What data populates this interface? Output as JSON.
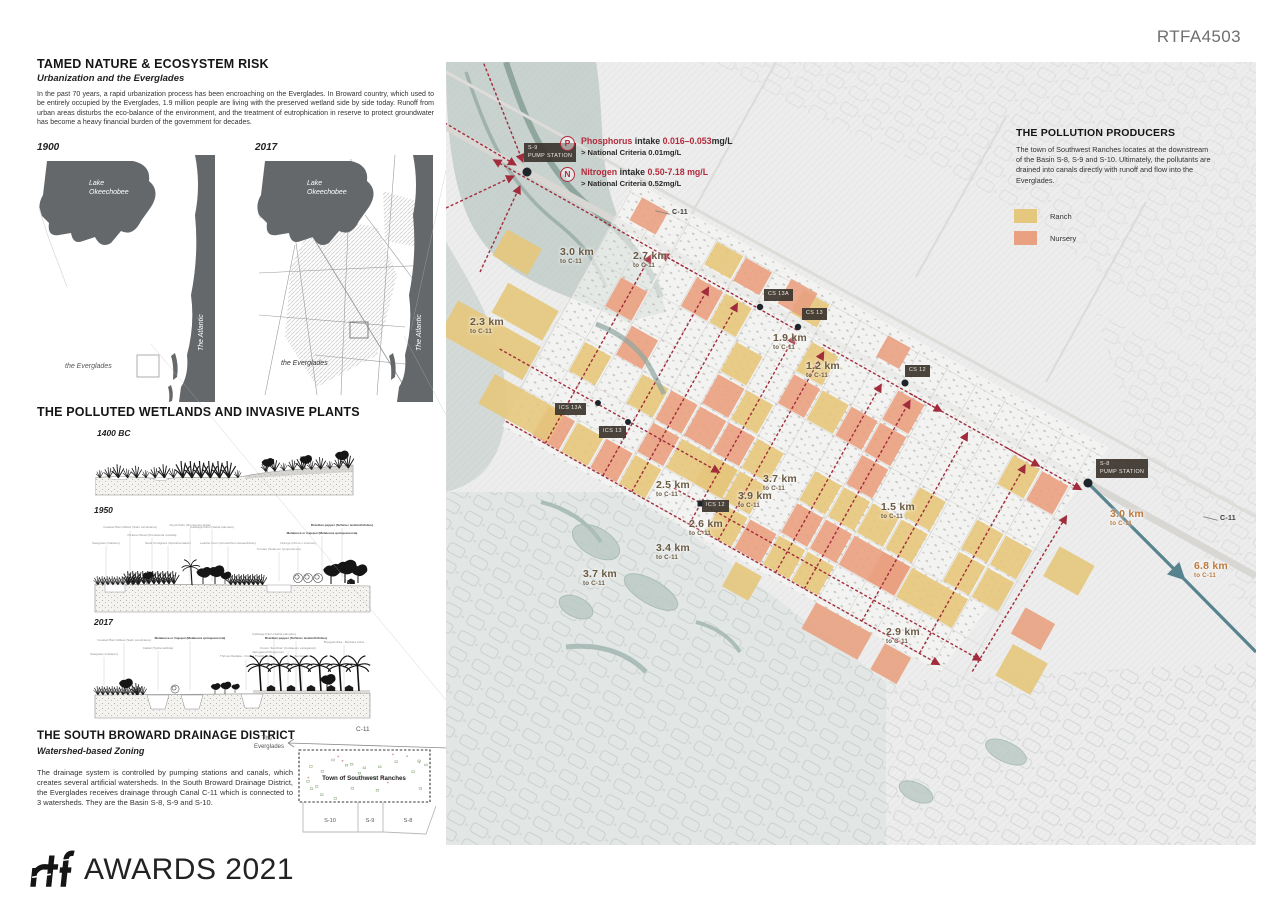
{
  "header": {
    "code": "RTFA4503"
  },
  "left": {
    "s1_title": "TAMED NATURE & ECOSYSTEM RISK",
    "s1_subtitle": "Urbanization and the Everglades",
    "s1_body": "In the past 70 years, a rapid urbanization process has been encroaching on the Everglades. In Broward country, which used to be entirely occupied by the Everglades, 1.9 million people are living with the preserved wetland side by side today. Runoff from urban areas disturbs the eco-balance of the environment, and the treatment of eutrophication in reserve to protect groundwater has become a heavy financial burden of the government for decades.",
    "maps": {
      "y1": "1900",
      "y2": "2017",
      "lake_l1": "Lake",
      "lake_l2": "Okeechobee",
      "everglades": "the Everglades",
      "atlantic": "The Atlantic"
    },
    "s2_title": "THE POLLUTED WETLANDS AND INVASIVE PLANTS",
    "eras": [
      "1400 BC",
      "1950",
      "2017"
    ],
    "plants1950": [
      {
        "t": "Sawgrass (Cladium)",
        "x": 10,
        "y": 30
      },
      {
        "t": "Coastal Plain Willow (Salix caroliniana)",
        "x": 34,
        "y": 14
      },
      {
        "t": "Pickerel Weed (Pontederia cordata)",
        "x": 56,
        "y": 22
      },
      {
        "t": "Sand Cordgrass (Spartina bakeri)",
        "x": 72,
        "y": 30
      },
      {
        "t": "Royal Palm (Roystonea elata)",
        "x": 94,
        "y": 12
      },
      {
        "t": "Cabbage Palm (Sabal palmetto)",
        "x": 116,
        "y": 14
      },
      {
        "t": "Leather Fern (Acrostichum danaeifolium)",
        "x": 132,
        "y": 30
      },
      {
        "t": "Tomato (Solanum lycopersicum)",
        "x": 183,
        "y": 36
      },
      {
        "t": "Orange (Citrus x sinensis)",
        "x": 202,
        "y": 30
      },
      {
        "t": "Melaleuca or Cajeput (Melaleuca quinquenervia)",
        "x": 226,
        "y": 20,
        "b": 1
      },
      {
        "t": "Brazilian pepper (Schinus terebinthifolius)",
        "x": 246,
        "y": 12,
        "b": 1
      }
    ],
    "plants2017": [
      {
        "t": "Sawgrass (Cladium)",
        "x": 8,
        "y": 28
      },
      {
        "t": "Coastal Plain Willow (Salix caroliniana)",
        "x": 28,
        "y": 14
      },
      {
        "t": "Cattail (Typha latifolia)",
        "x": 62,
        "y": 22
      },
      {
        "t": "Melaleuca or Cajeput (Melaleuca quinquenervia)",
        "x": 94,
        "y": 12,
        "b": 1
      },
      {
        "t": "Thrinax Radiata - Florida Thatch Palm",
        "x": 150,
        "y": 30
      },
      {
        "t": "Variegated Pittosporum",
        "x": 172,
        "y": 26
      },
      {
        "t": "Croton 'Zanzibar' (Codiaeum variegatum)",
        "x": 192,
        "y": 22
      },
      {
        "t": "Succulents",
        "x": 206,
        "y": 30
      },
      {
        "t": "Cabbage Palm (Sabal palmetto)",
        "x": 178,
        "y": 8
      },
      {
        "t": "Brazilian pepper (Schinus terebinthifolius)",
        "x": 200,
        "y": 12,
        "b": 1
      },
      {
        "t": "Bougainvillea - Barbara Karst",
        "x": 248,
        "y": 16
      }
    ],
    "s3_title": "THE SOUTH BROWARD DRAINAGE DISTRICT",
    "s3_subtitle": "Watershed-based Zoning",
    "s3_body": "The drainage system is controlled by pumping stations and canals, which creates several artificial watersheds. In the South Broward Drainage District, the Everglades receives drainage through Canal C-11 which is connected to 3 watersheds. They are the Basin S-8, S-9 and S-10.",
    "inset": {
      "canal": "C-11",
      "the": "The",
      "everglades": "Everglades",
      "town": "Town of Southwest Ranches",
      "basins": [
        "S-10",
        "S-9",
        "S-8"
      ]
    }
  },
  "map": {
    "producers_title": "THE POLLUTION PRODUCERS",
    "producers_body": "The town of Southwest Ranches locates at the downstream of the Basin S-8, S-9 and S-10. Ultimately, the pollutants  are drained into canals directly with runoff and flow into the Everglades.",
    "legend": [
      {
        "label": "Ranch",
        "color": "#e5c77d"
      },
      {
        "label": "Nursery",
        "color": "#e9a181"
      }
    ],
    "intake": [
      {
        "sym": "P",
        "line1": [
          {
            "t": "Phosphorus ",
            "red": 1
          },
          {
            "t": "intake ",
            "red": 0
          },
          {
            "t": "0.016–0.053",
            "red": 1
          },
          {
            "t": "mg/L",
            "red": 0
          }
        ],
        "line2": "> National Criteria  0.01mg/L"
      },
      {
        "sym": "N",
        "line1": [
          {
            "t": "Nitrogen ",
            "red": 1
          },
          {
            "t": "intake ",
            "red": 0
          },
          {
            "t": "0.50-7.18 mg/L",
            "red": 1
          }
        ],
        "line2": "> National Criteria 0.52mg/L"
      }
    ],
    "stations": [
      {
        "lines": [
          "S-9",
          "PUMP STATION"
        ],
        "x": 524,
        "y": 143
      },
      {
        "lines": [
          "CS 13A"
        ],
        "x": 764,
        "y": 289
      },
      {
        "lines": [
          "CS 13"
        ],
        "x": 802,
        "y": 308
      },
      {
        "lines": [
          "CS 12"
        ],
        "x": 905,
        "y": 365
      },
      {
        "lines": [
          "ICS 13A"
        ],
        "x": 555,
        "y": 403
      },
      {
        "lines": [
          "ICS 13"
        ],
        "x": 599,
        "y": 426
      },
      {
        "lines": [
          "ICS 12"
        ],
        "x": 702,
        "y": 500
      },
      {
        "lines": [
          "S-8",
          "PUMP STATION"
        ],
        "x": 1096,
        "y": 459
      }
    ],
    "distances": [
      {
        "km": "3.0 km",
        "to": "to C-11",
        "x": 560,
        "y": 247,
        "c": "dark"
      },
      {
        "km": "2.7 km",
        "to": "to C-11",
        "x": 633,
        "y": 251,
        "c": "dark"
      },
      {
        "km": "2.3 km",
        "to": "to C-11",
        "x": 470,
        "y": 317,
        "c": "dark"
      },
      {
        "km": "1.9 km",
        "to": "to C-11",
        "x": 773,
        "y": 333,
        "c": "dark"
      },
      {
        "km": "1.2 km",
        "to": "to C-11",
        "x": 806,
        "y": 361,
        "c": "dark"
      },
      {
        "km": "2.5 km",
        "to": "to C-11",
        "x": 656,
        "y": 480,
        "c": "dark"
      },
      {
        "km": "3.7 km",
        "to": "to C-11",
        "x": 763,
        "y": 474,
        "c": "dark"
      },
      {
        "km": "3.9 km",
        "to": "to C-11",
        "x": 738,
        "y": 491,
        "c": "dark"
      },
      {
        "km": "2.6 km",
        "to": "to C-11",
        "x": 689,
        "y": 519,
        "c": "dark"
      },
      {
        "km": "1.5 km",
        "to": "to C-11",
        "x": 881,
        "y": 502,
        "c": "dark"
      },
      {
        "km": "3.4 km",
        "to": "to C-11",
        "x": 656,
        "y": 543,
        "c": "dark"
      },
      {
        "km": "3.7 km",
        "to": "to C-11",
        "x": 583,
        "y": 569,
        "c": "dark"
      },
      {
        "km": "3.0 km",
        "to": "to C-11",
        "x": 1110,
        "y": 509,
        "c": "orange"
      },
      {
        "km": "6.8 km",
        "to": "to C-11",
        "x": 1194,
        "y": 561,
        "c": "orange"
      },
      {
        "km": "2.9 km",
        "to": "to C-11",
        "x": 886,
        "y": 627,
        "c": "dark"
      }
    ],
    "canal_labels": [
      {
        "text": "C-11",
        "x": 655,
        "y": 209
      },
      {
        "text": "C-11",
        "x": 1203,
        "y": 515
      }
    ]
  },
  "footer": {
    "logo": "rtf",
    "text": "AWARDS 2021"
  }
}
